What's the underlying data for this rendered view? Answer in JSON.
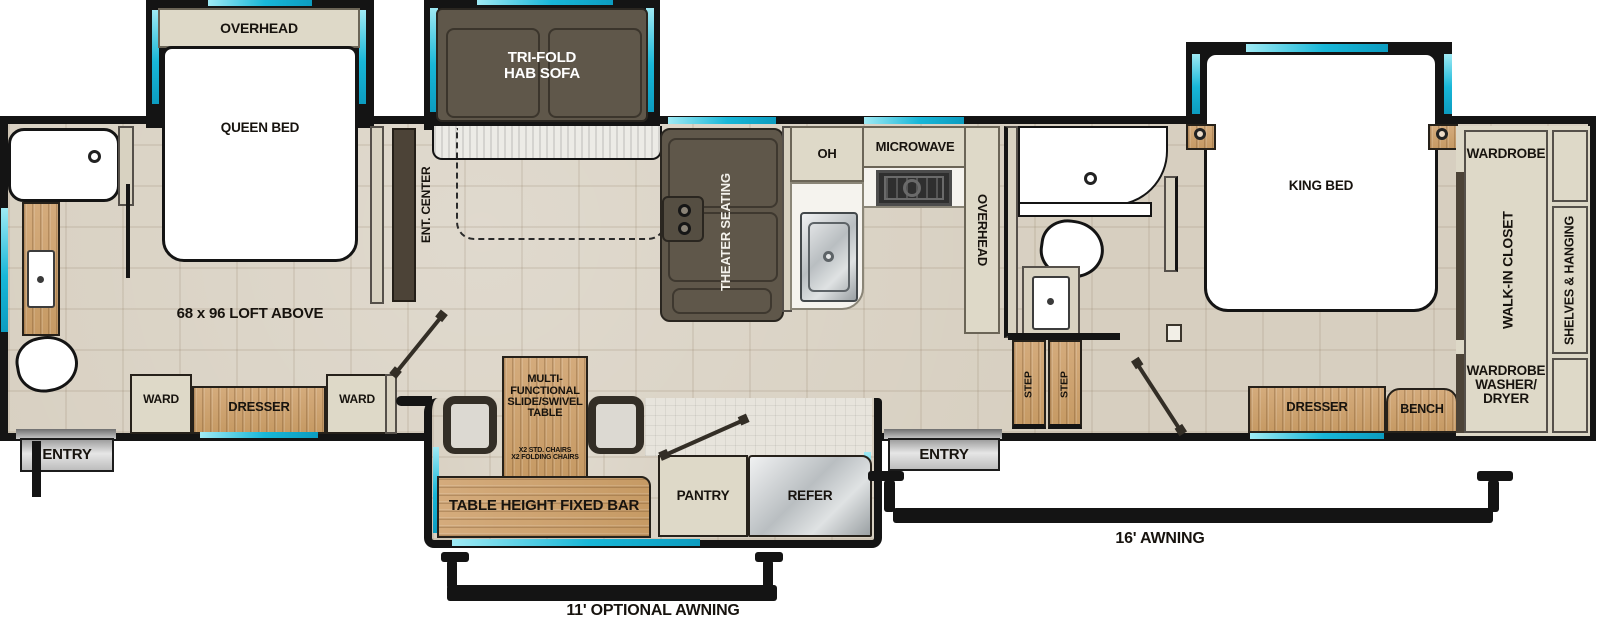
{
  "colors": {
    "accent_teal": "#18b7d8",
    "wall_black": "#141414",
    "floor_tan": "#d7cfc0",
    "cabinet_beige": "#ded9c8",
    "wood_tan": "#cda571",
    "sofa_brown": "#5f574a",
    "stainless_gray": "#c7cacb"
  },
  "slides": {
    "queen_overhead": "OVERHEAD",
    "queen_bed": "QUEEN BED",
    "sofa_line1": "TRI-FOLD",
    "sofa_line2": "HAB SOFA",
    "king_bed": "KING BED"
  },
  "living": {
    "ent_center": "ENT. CENTER",
    "theater": "THEATER SEATING",
    "loft": "68 x 96 LOFT ABOVE"
  },
  "kitchen": {
    "oh": "OH",
    "microwave": "MICROWAVE",
    "overhead": "OVERHEAD",
    "pantry": "PANTRY",
    "refer": "REFER"
  },
  "dinette": {
    "t1": "MULTI-",
    "t2": "FUNCTIONAL",
    "t3": "SLIDE/SWIVEL",
    "t4": "TABLE",
    "c1": "X2 STD. CHAIRS",
    "c2": "X2 FOLDING CHAIRS",
    "bar": "TABLE HEIGHT FIXED BAR"
  },
  "front_bedroom": {
    "ward1": "WARD",
    "dresser": "DRESSER",
    "ward2": "WARD"
  },
  "bath": {
    "step1": "STEP",
    "step2": "STEP"
  },
  "master": {
    "dresser": "DRESSER",
    "bench": "BENCH"
  },
  "closet": {
    "wardrobe_top": "WARDROBE",
    "walk_in": "WALK-IN CLOSET",
    "shelves": "SHELVES & HANGING",
    "wd_line1": "WARDROBE",
    "wd_line2": "WASHER/",
    "wd_line3": "DRYER"
  },
  "entries": {
    "left": "ENTRY",
    "right": "ENTRY"
  },
  "awnings": {
    "rear": "11' OPTIONAL AWNING",
    "main": "16' AWNING"
  }
}
